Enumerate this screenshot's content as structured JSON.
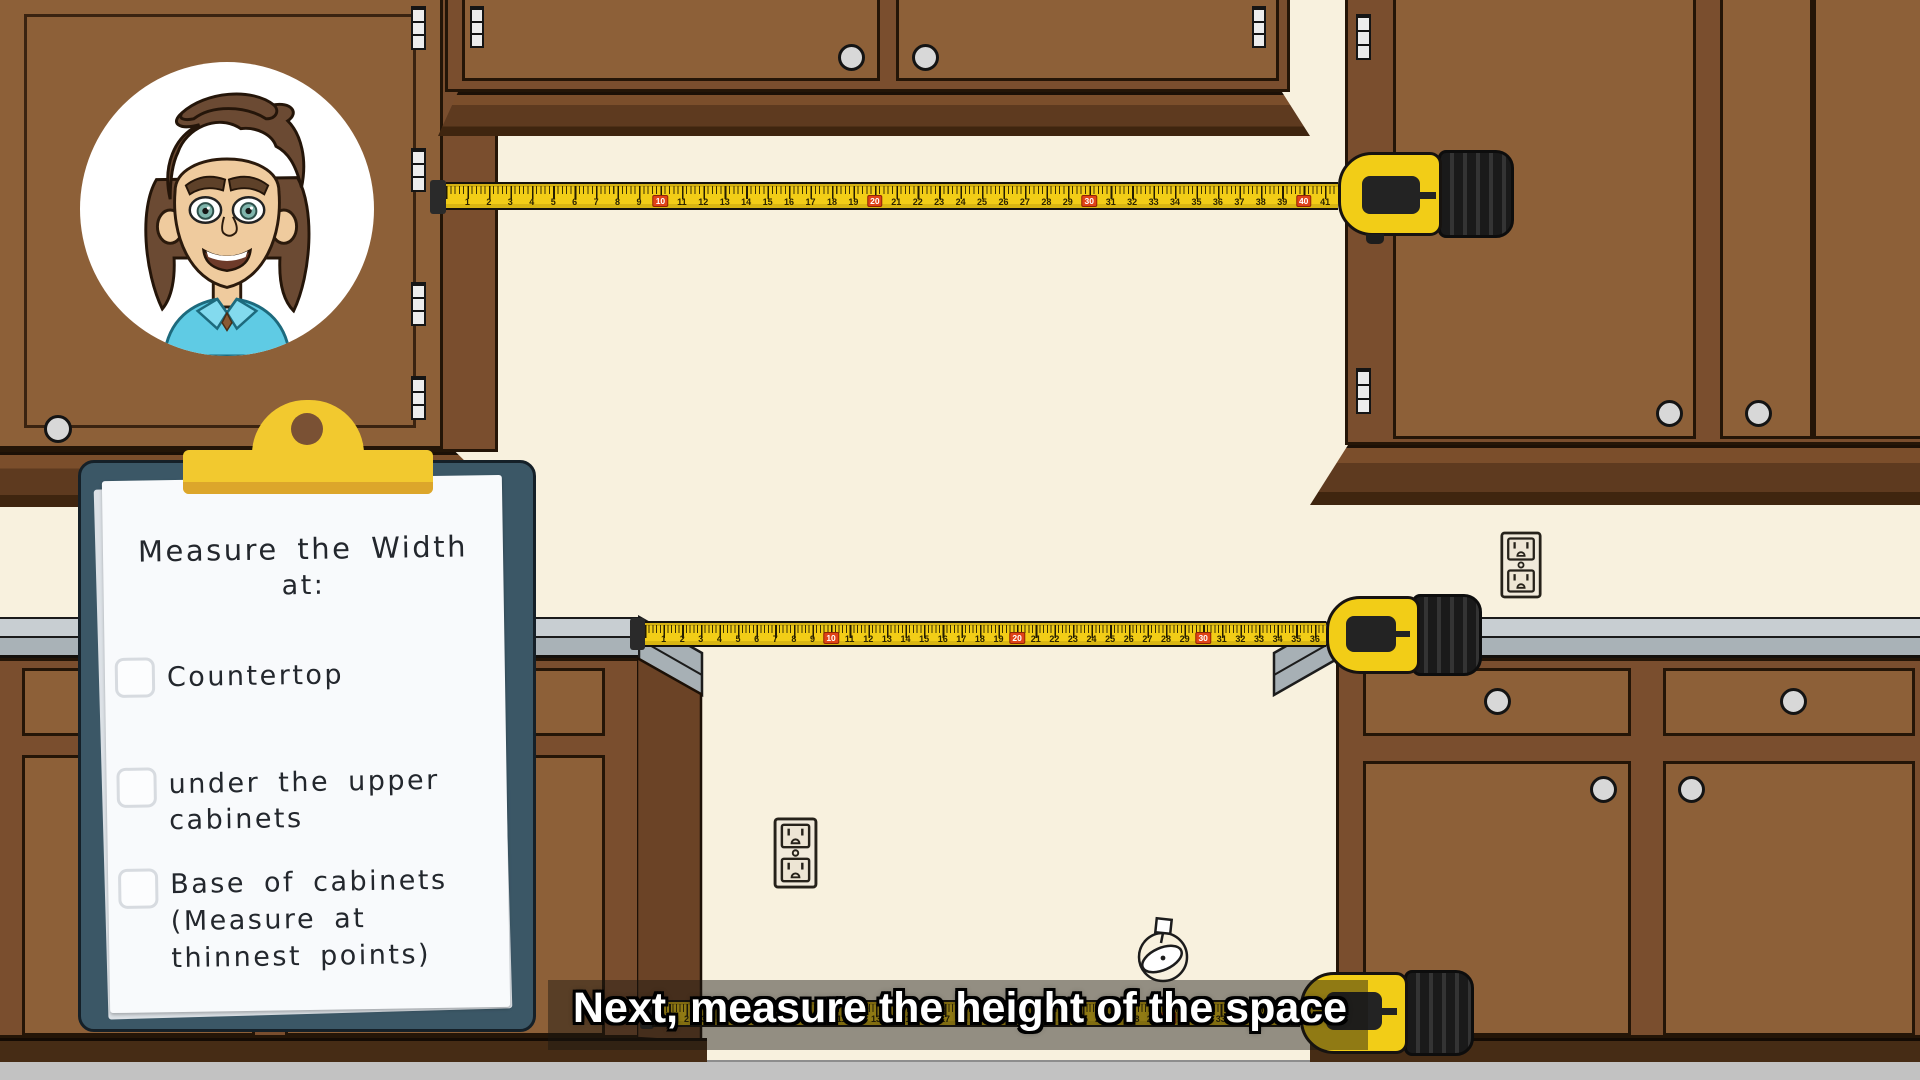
{
  "caption": {
    "text": "Next, measure the height of the space"
  },
  "clipboard": {
    "title_lines": [
      "Measure the Width",
      "at:"
    ],
    "items": [
      {
        "lines": [
          "Countertop"
        ],
        "checked": false
      },
      {
        "lines": [
          "under the upper",
          "cabinets"
        ],
        "checked": false
      },
      {
        "lines": [
          "Base of cabinets",
          "(Measure at",
          "thinnest points)"
        ],
        "checked": false
      }
    ]
  },
  "tapes": {
    "top": {
      "units": 41,
      "red_every": 10
    },
    "middle": {
      "units": 36,
      "red_every": 10
    },
    "bottom": {
      "units": 37,
      "red_every": 10
    }
  },
  "colors": {
    "wall": "#F8F1DE",
    "cabinet": "#8D6038",
    "cabinet_frame": "#7A4E2E",
    "countertop": "#C8CED2",
    "clipboard_board": "#3B5766",
    "clip_yellow": "#F2C92F",
    "tape_yellow": "#F2CD17",
    "tape_red_marker": "#E04318",
    "caption_text": "#FFFFFF"
  }
}
